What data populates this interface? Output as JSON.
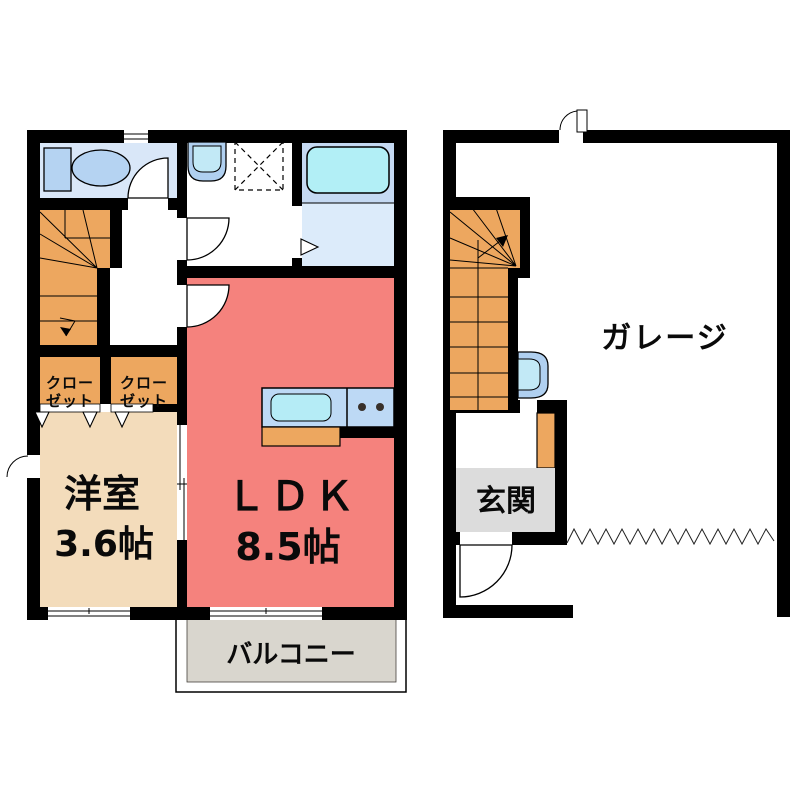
{
  "page": {
    "background": "#ffffff"
  },
  "palette": {
    "wall": "#000000",
    "toilet_room_bg": "#d9e7f8",
    "fixture_blue": "#b5d3f2",
    "basin_outer": "#b0d0f0",
    "basin_inner": "#c2e9f6",
    "bath_upper_bg": "#c5d9f2",
    "bath_lower_bg": "#dcebfa",
    "tub_cyan": "#b2eff6",
    "counter_blue": "#bdd9f5",
    "sink_cyan": "#b5ecf6",
    "ldk_red": "#f5827d",
    "room_tan": "#f3dcbb",
    "stair_orange": "#eda75f",
    "balcony_gray": "#d9d6ce",
    "genkan_gray": "#dcdcdc",
    "burner_dark": "#38302a"
  },
  "second_floor": {
    "western_room": {
      "label": "洋室",
      "size": "3.6帖"
    },
    "ldk": {
      "label": "ＬＤＫ",
      "size": "8.5帖"
    },
    "balcony": {
      "label": "バルコニー"
    },
    "closet": {
      "line1": "クロー",
      "line2": "ゼット"
    },
    "fixtures": [
      "toilet",
      "vanity",
      "washbasin",
      "washing-machine-pan",
      "bathtub",
      "kitchen-sink",
      "gas-stove",
      "stairs",
      "closet-folding-doors",
      "sliding-door",
      "windows"
    ]
  },
  "first_floor": {
    "garage": {
      "label": "ガレージ"
    },
    "entrance": {
      "label": "玄関"
    },
    "fixtures": [
      "stairs",
      "utility-basin",
      "shoe-cabinet",
      "entry-door",
      "back-door",
      "garage-shutter"
    ]
  }
}
